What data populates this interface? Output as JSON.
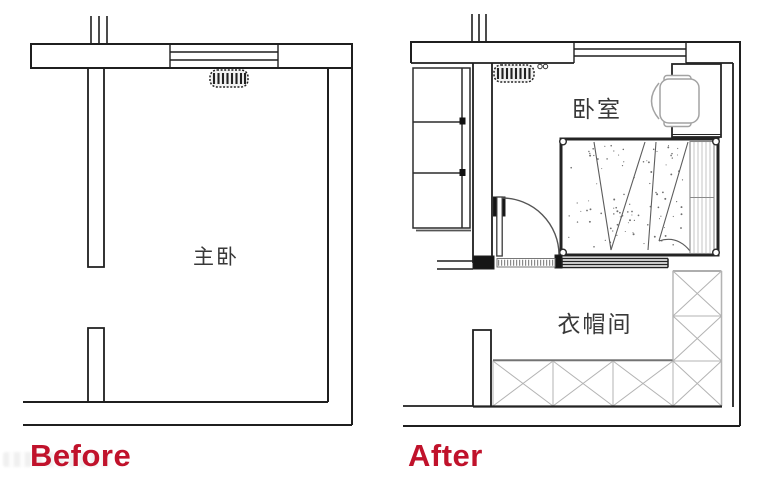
{
  "captions": {
    "before": "Before",
    "after": "After"
  },
  "rooms": {
    "before_room": "主卧",
    "after_bedroom": "卧室",
    "after_cloakroom": "衣帽间"
  },
  "colors": {
    "accent_red": "#c0122b",
    "wall_line": "#1f1f1f",
    "furniture_gray": "#a3a3a3",
    "background": "#ffffff"
  },
  "icons": {
    "radiator": "rounded bar with vertical hatch",
    "window": "four parallel lines in wall",
    "pipe_stack": "three short ticks above wall",
    "door_swing": "quarter-circle arc with leaf",
    "closet_module": "square with X cross",
    "bed": "rect with corner posts, speckled duvet, fold lines",
    "desk_chair": "rect desk with round-back chair"
  }
}
